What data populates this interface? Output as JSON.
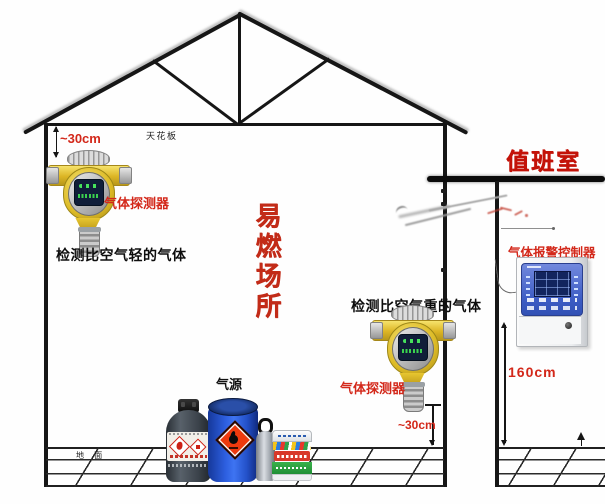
{
  "diagram": {
    "room": {
      "ceiling_label": "天花板",
      "ground_label": "地 面",
      "area_label": "易燃场所"
    },
    "gas_source": {
      "label": "气源"
    },
    "detector_top": {
      "label": "气体探测器",
      "note": "检测比空气轻的气体",
      "clearance": "~30cm"
    },
    "detector_bottom": {
      "label": "气体探测器",
      "note": "检测比空气重的气体",
      "clearance": "~30cm"
    },
    "duty_room": {
      "label": "值班室",
      "controller_label": "气体报警控制器",
      "mount_height": "160cm"
    },
    "colors": {
      "label_red": "#d3281a",
      "title_red": "#c31309",
      "detector_yellow": "#ddb71f",
      "controller_panel_blue": "#4f6cc9",
      "drum_blue": "#2353cf",
      "hazard_diamond_orange": "#ee3a0e",
      "line_black": "#1a1a1a"
    }
  }
}
